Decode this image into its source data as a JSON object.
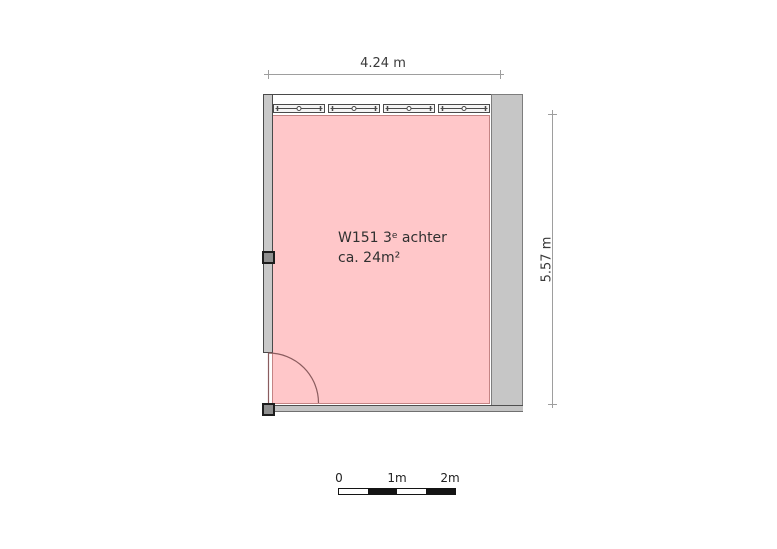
{
  "dimensions": {
    "width_label": "4.24 m",
    "height_label": "5.57 m"
  },
  "room": {
    "label_line1_pre": "W151 3",
    "label_line1_sup": "e",
    "label_line1_post": " achter",
    "label_line2": "ca. 24m²"
  },
  "windows": {
    "count": 4
  },
  "scale_bar": {
    "labels": [
      "0",
      "1m",
      "2m"
    ],
    "segments": 4
  },
  "colors": {
    "room_fill": "#ffc7c9",
    "room_border": "#c48484",
    "wall_fill": "#c9c9c9",
    "wall_line": "#4a4a4a",
    "window_fill": "#f4f4f4",
    "door_arc": "#8a5c5e",
    "dimension_line": "#9e9e9e",
    "scale_dark": "#141414",
    "scale_light": "#ffffff",
    "text": "#3a3a3a"
  }
}
